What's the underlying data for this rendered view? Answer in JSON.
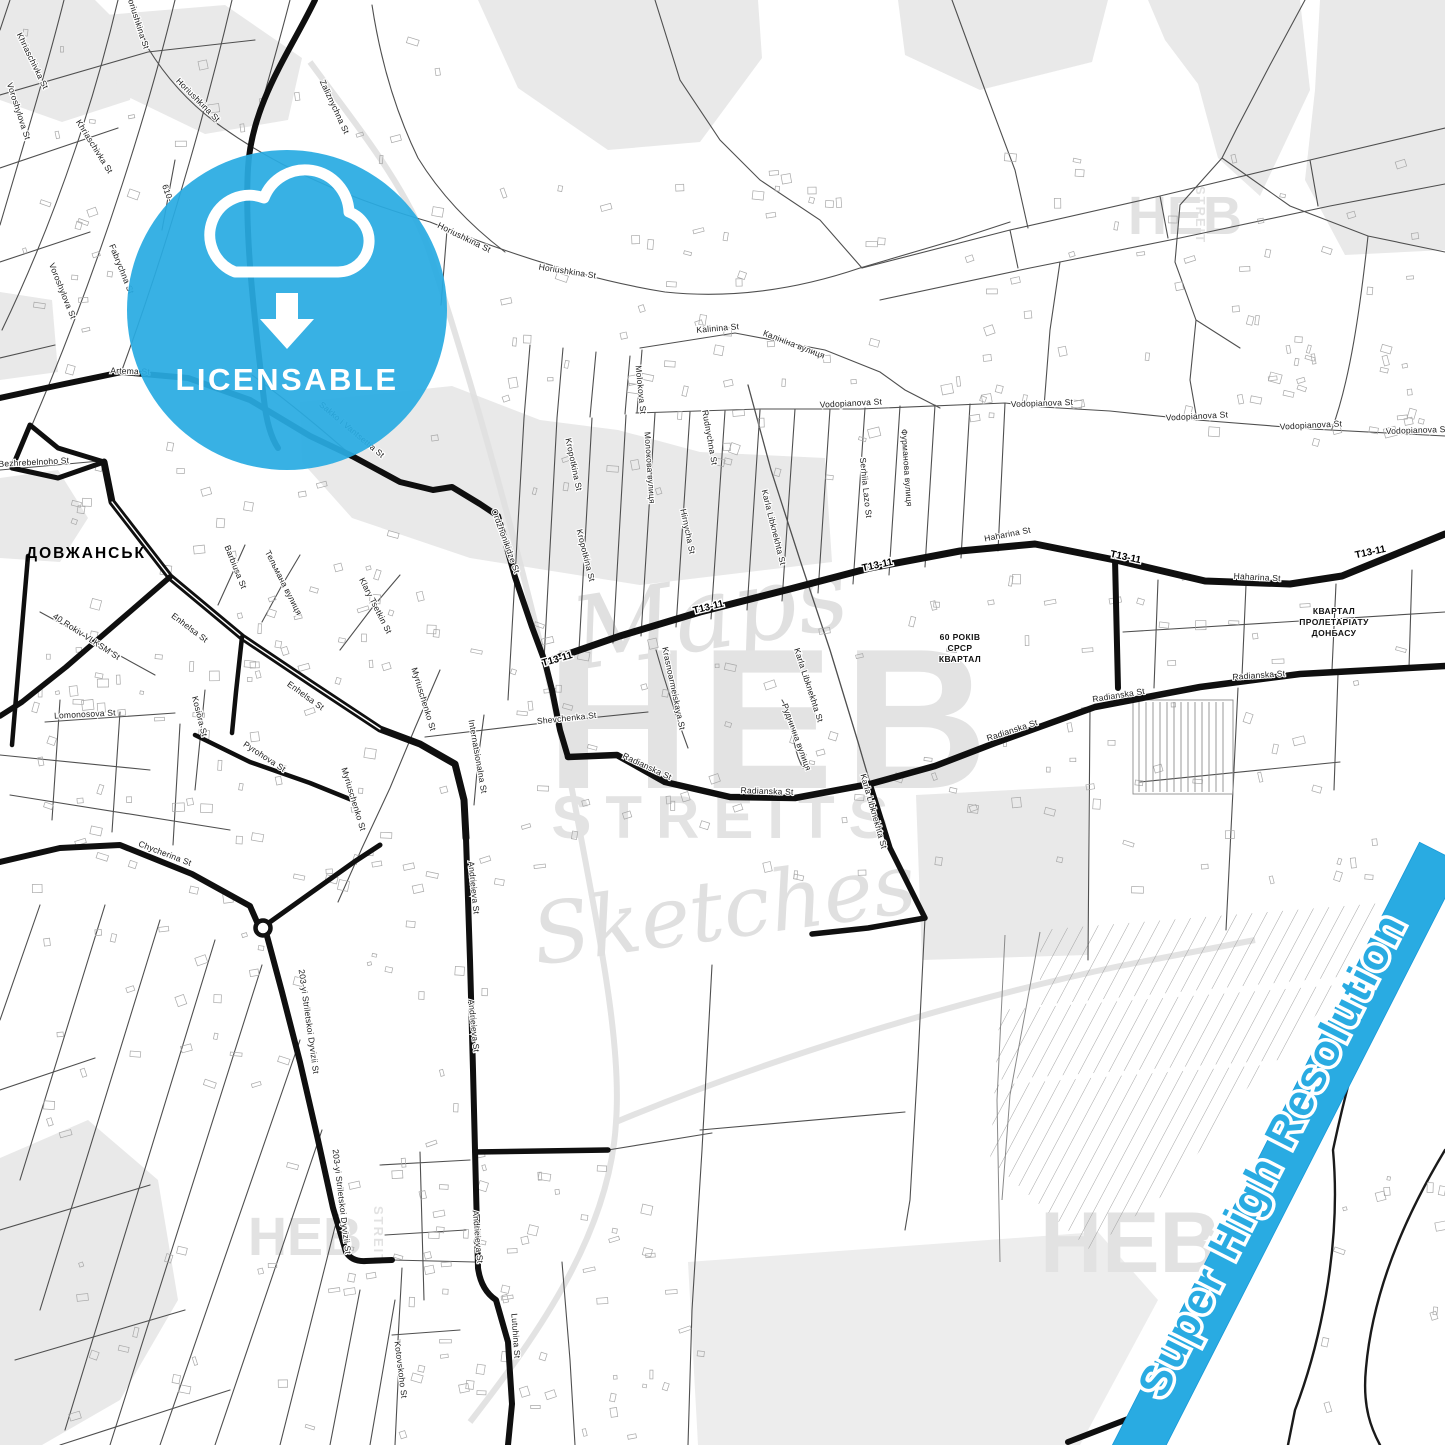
{
  "map": {
    "city_label": "ДОВЖАНСЬК",
    "streets": {
      "khriaschivka": "Khriaschivka St",
      "horiushkina": "Horiushkina St",
      "voroshylova": "Voroshylova St",
      "fabrychna": "Fabrychna St",
      "zaliznychna": "Zaliznychna St",
      "marker_610": "610-",
      "artema": "Artema St",
      "bezhrebelnoho": "Bezhrebelnoho St",
      "sakko_vantsetti": "Sakko i Vantsettia St",
      "ordzhonikidze": "Ordzhonikidze St",
      "kropotkina": "Kropotkina St",
      "molokova_en": "Molokova St",
      "molokova_ua": "Молокова вулиця",
      "rudnychna_en": "Rudnychna St",
      "rudnychna_ua": "Руднична вулиця",
      "hirnycha": "Hirnycha St",
      "karla_libknekhta": "Karla Libknekhta St",
      "serhiia_lazo": "Serhiia Lazo St",
      "furmanova_ua": "Фурманова вулиця",
      "kalinina_en": "Kalinina St",
      "kalinina_ua": "Калініна вулиця",
      "vodopianova": "Vodopianova St",
      "haharina": "Haharina St",
      "t13_11": "T13-11",
      "radianska": "Radianska St",
      "shevchenka": "Shevchenka St",
      "krasnoarmeiskaya": "Krasnoarmeiskaya St",
      "enhelsa": "Enhelsa St",
      "barbiusa": "Barbiusa St",
      "telmana_ua": "Тельмана вулиця",
      "klary_tsetkin": "Klary Tsetkin St",
      "myriuschenko": "Myriuschenko St",
      "kosiora": "Kosiora St",
      "pyrohova": "Pyrohova St",
      "lomonosova": "Lomonosova St",
      "rokiv_vlksm": "40 Rokiv VLKSM St",
      "chycherina": "Chycherina St",
      "internatsionalna": "Internatsionalna St",
      "andrieieva": "Andrieieva St",
      "striletskoi_dyvizii": "203-yi Striletskoi Dyvizii St",
      "lutuhina": "Lutuhina St",
      "kotovskoho": "Kotovskoho St"
    },
    "districts": {
      "kvartal_60": [
        "60 РОКІВ",
        "СРСР",
        "КВАРТАЛ"
      ],
      "kvartal_proletariatu": [
        "КВАРТАЛ",
        "ПРОЛЕТАРІАТУ",
        "ДОНБАСУ"
      ]
    }
  },
  "badge": {
    "label": "LICENSABLE",
    "icon": "cloud-download-icon",
    "color": "#29ABE2"
  },
  "river_banner": {
    "text": "Super High Resolution",
    "color": "#29ABE2"
  },
  "watermark": {
    "line1": "Maps",
    "line2": "HEB",
    "line3": "STREITS",
    "line4": "Sketches",
    "corner_word": "HEB",
    "corner_vertical": "STREIT"
  },
  "colors": {
    "accent_blue": "#29ABE2",
    "map_background": "#ffffff",
    "area_gray": "#e9e9e9",
    "major_road": "#0f0f0f",
    "minor_road": "#4f4f4f"
  }
}
